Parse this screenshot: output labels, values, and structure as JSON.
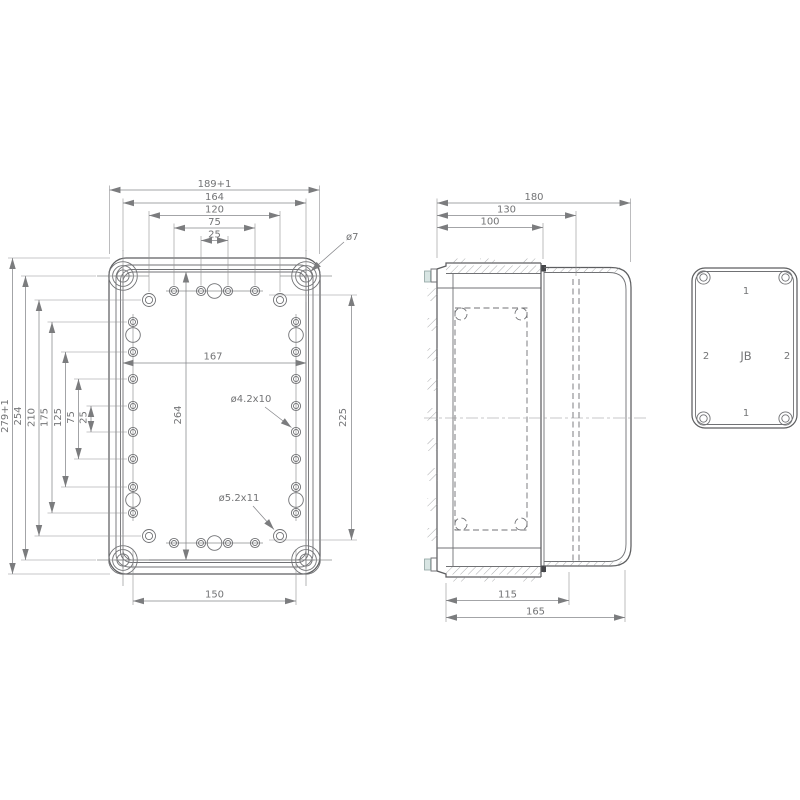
{
  "colors": {
    "background": "#ffffff",
    "line_dark": "#5d5e60",
    "line_medium": "#707174",
    "line_light": "#8a8b8d",
    "text": "#737476",
    "gasket_accent": "#d8e5e3"
  },
  "front_view": {
    "dims_top": [
      "189+1",
      "164",
      "120",
      "75",
      "25"
    ],
    "dims_left": [
      "279+1",
      "254",
      "210",
      "175",
      "125",
      "75",
      "25"
    ],
    "dim_bottom": "150",
    "dim_inner_width": "167",
    "dim_inner_height": "264",
    "dim_rows_spacing": "225",
    "callout_cover_screw_hole": "ø7",
    "callout_side_hole": "ø4.2x10",
    "callout_corner_hole": "ø5.2x11"
  },
  "side_view": {
    "dims_top": [
      "180",
      "130",
      "100"
    ],
    "dims_bottom": [
      "115",
      "165"
    ]
  },
  "lid_view": {
    "label_top": "1",
    "label_bottom": "1",
    "label_left": "2",
    "label_right": "2",
    "label_center": "JB"
  }
}
